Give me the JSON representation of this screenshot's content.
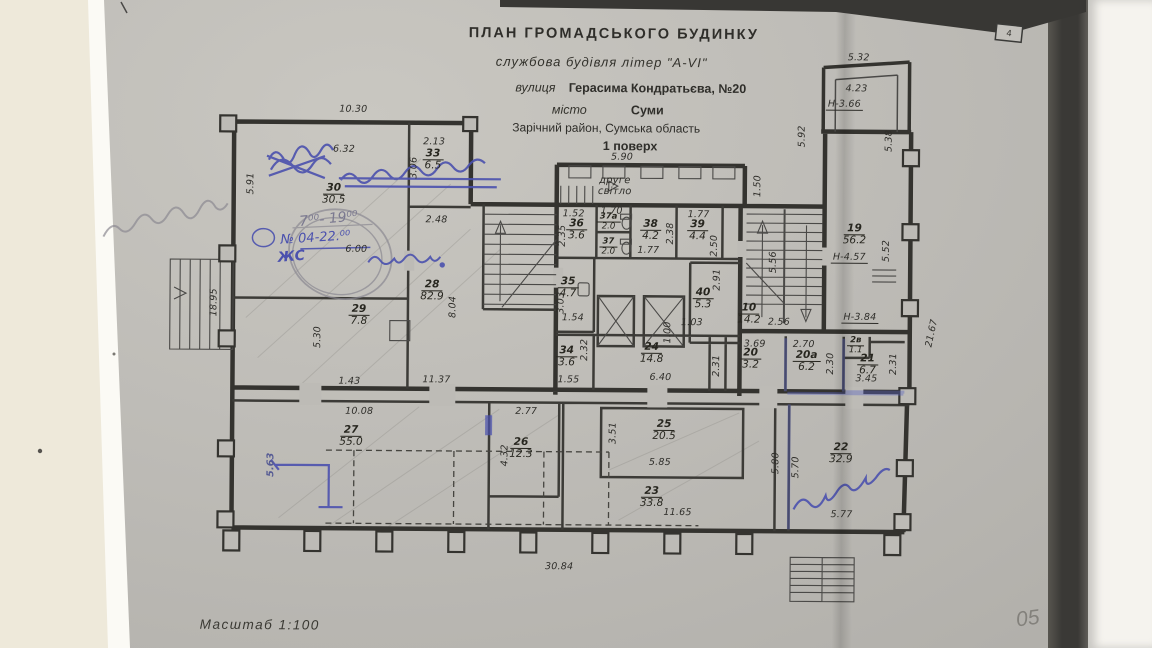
{
  "title_block": {
    "line1": "ПЛАН  ГРОМАДСЬКОГО  БУДИНКУ",
    "line2": "службова будівля літер \"А-VI\"",
    "line3_label": "вулиця",
    "line3_value": "Герасима Кондратьєва, №20",
    "line4_label": "місто",
    "line4_value": "Суми",
    "line5": "Зарічний район, Сумська область",
    "line6": "1 поверх"
  },
  "scale_label": "Масштаб  1:100",
  "core_label": "друге\nсвітло",
  "photo": {
    "page_corner_number": "4"
  },
  "handwriting": {
    "hours": "7⁰⁰- 19⁰⁰",
    "permit": "№ 04-22.⁰⁰",
    "initials": "ЖС",
    "corner_mark": "05"
  },
  "height_notes": {
    "n1": "Н-3.66",
    "n2": "Н-4.57",
    "n3": "Н-3.84"
  },
  "rooms": {
    "r30": {
      "num": "30",
      "area": "30.5"
    },
    "r33": {
      "num": "33",
      "area": "6.5"
    },
    "r29": {
      "num": "29",
      "area": "7.8"
    },
    "r28": {
      "num": "28",
      "area": "82.9"
    },
    "r36": {
      "num": "36",
      "area": "3.6"
    },
    "r37a": {
      "num": "37а",
      "area": "2.0"
    },
    "r37": {
      "num": "37",
      "area": "2.0"
    },
    "r38": {
      "num": "38",
      "area": "4.2"
    },
    "r39": {
      "num": "39",
      "area": "4.4"
    },
    "r35": {
      "num": "35",
      "area": "4.7"
    },
    "r40": {
      "num": "40",
      "area": "5.3"
    },
    "r10": {
      "num": "10",
      "area": "14.2"
    },
    "r19": {
      "num": "19",
      "area": "56.2"
    },
    "r24": {
      "num": "24",
      "area": "14.8"
    },
    "r20": {
      "num": "20",
      "area": "3.2"
    },
    "r20a": {
      "num": "20а",
      "area": "6.2"
    },
    "r2v": {
      "num": "2в",
      "area": "1.1"
    },
    "r21": {
      "num": "21",
      "area": "6.7"
    },
    "r34": {
      "num": "34",
      "area": "3.6"
    },
    "r25": {
      "num": "25",
      "area": "20.5"
    },
    "r23": {
      "num": "23",
      "area": "33.8"
    },
    "r27": {
      "num": "27",
      "area": "55.0"
    },
    "r26": {
      "num": "26",
      "area": "12.3"
    },
    "r22": {
      "num": "22",
      "area": "32.9"
    }
  },
  "dims": {
    "d1": "10.30",
    "d2": "6.32",
    "d3": "2.13",
    "d4": "3.06",
    "d5": "5.91",
    "d6": "2.48",
    "d7": "5.90",
    "d8": "1.50",
    "d9": "1.52",
    "d10": "1.70",
    "d11": "2.35",
    "d12": "1.77",
    "d13": "2.38",
    "d14": "2.50",
    "d15": "1.77",
    "d16": "3.03",
    "d17": "1.54",
    "d18": "2.91",
    "d19": "1.03",
    "d20": "5.56",
    "d21": "2.56",
    "d22": "5.32",
    "d23": "4.23",
    "d24": "5.92",
    "d25": "5.38",
    "d26": "5.52",
    "d27": "21.67",
    "d28": "18.95",
    "d29": "5.30",
    "d30": "1.43",
    "d31": "11.37",
    "d32": "8.04",
    "d33": "6.00",
    "d34": "10.08",
    "d35": "5.63",
    "d36": "2.77",
    "d37": "4.32",
    "d38": "2.32",
    "d39": "1.55",
    "d40": "6.40",
    "d41": "3.69",
    "d42": "2.31",
    "d43": "2.70",
    "d44": "2.30",
    "d45": "3.45",
    "d46": "2.31",
    "d47": "3.51",
    "d48": "5.85",
    "d49": "11.65",
    "d50": "5.80",
    "d51": "5.70",
    "d52": "5.77",
    "d53": "30.84",
    "d54": "1.00"
  }
}
